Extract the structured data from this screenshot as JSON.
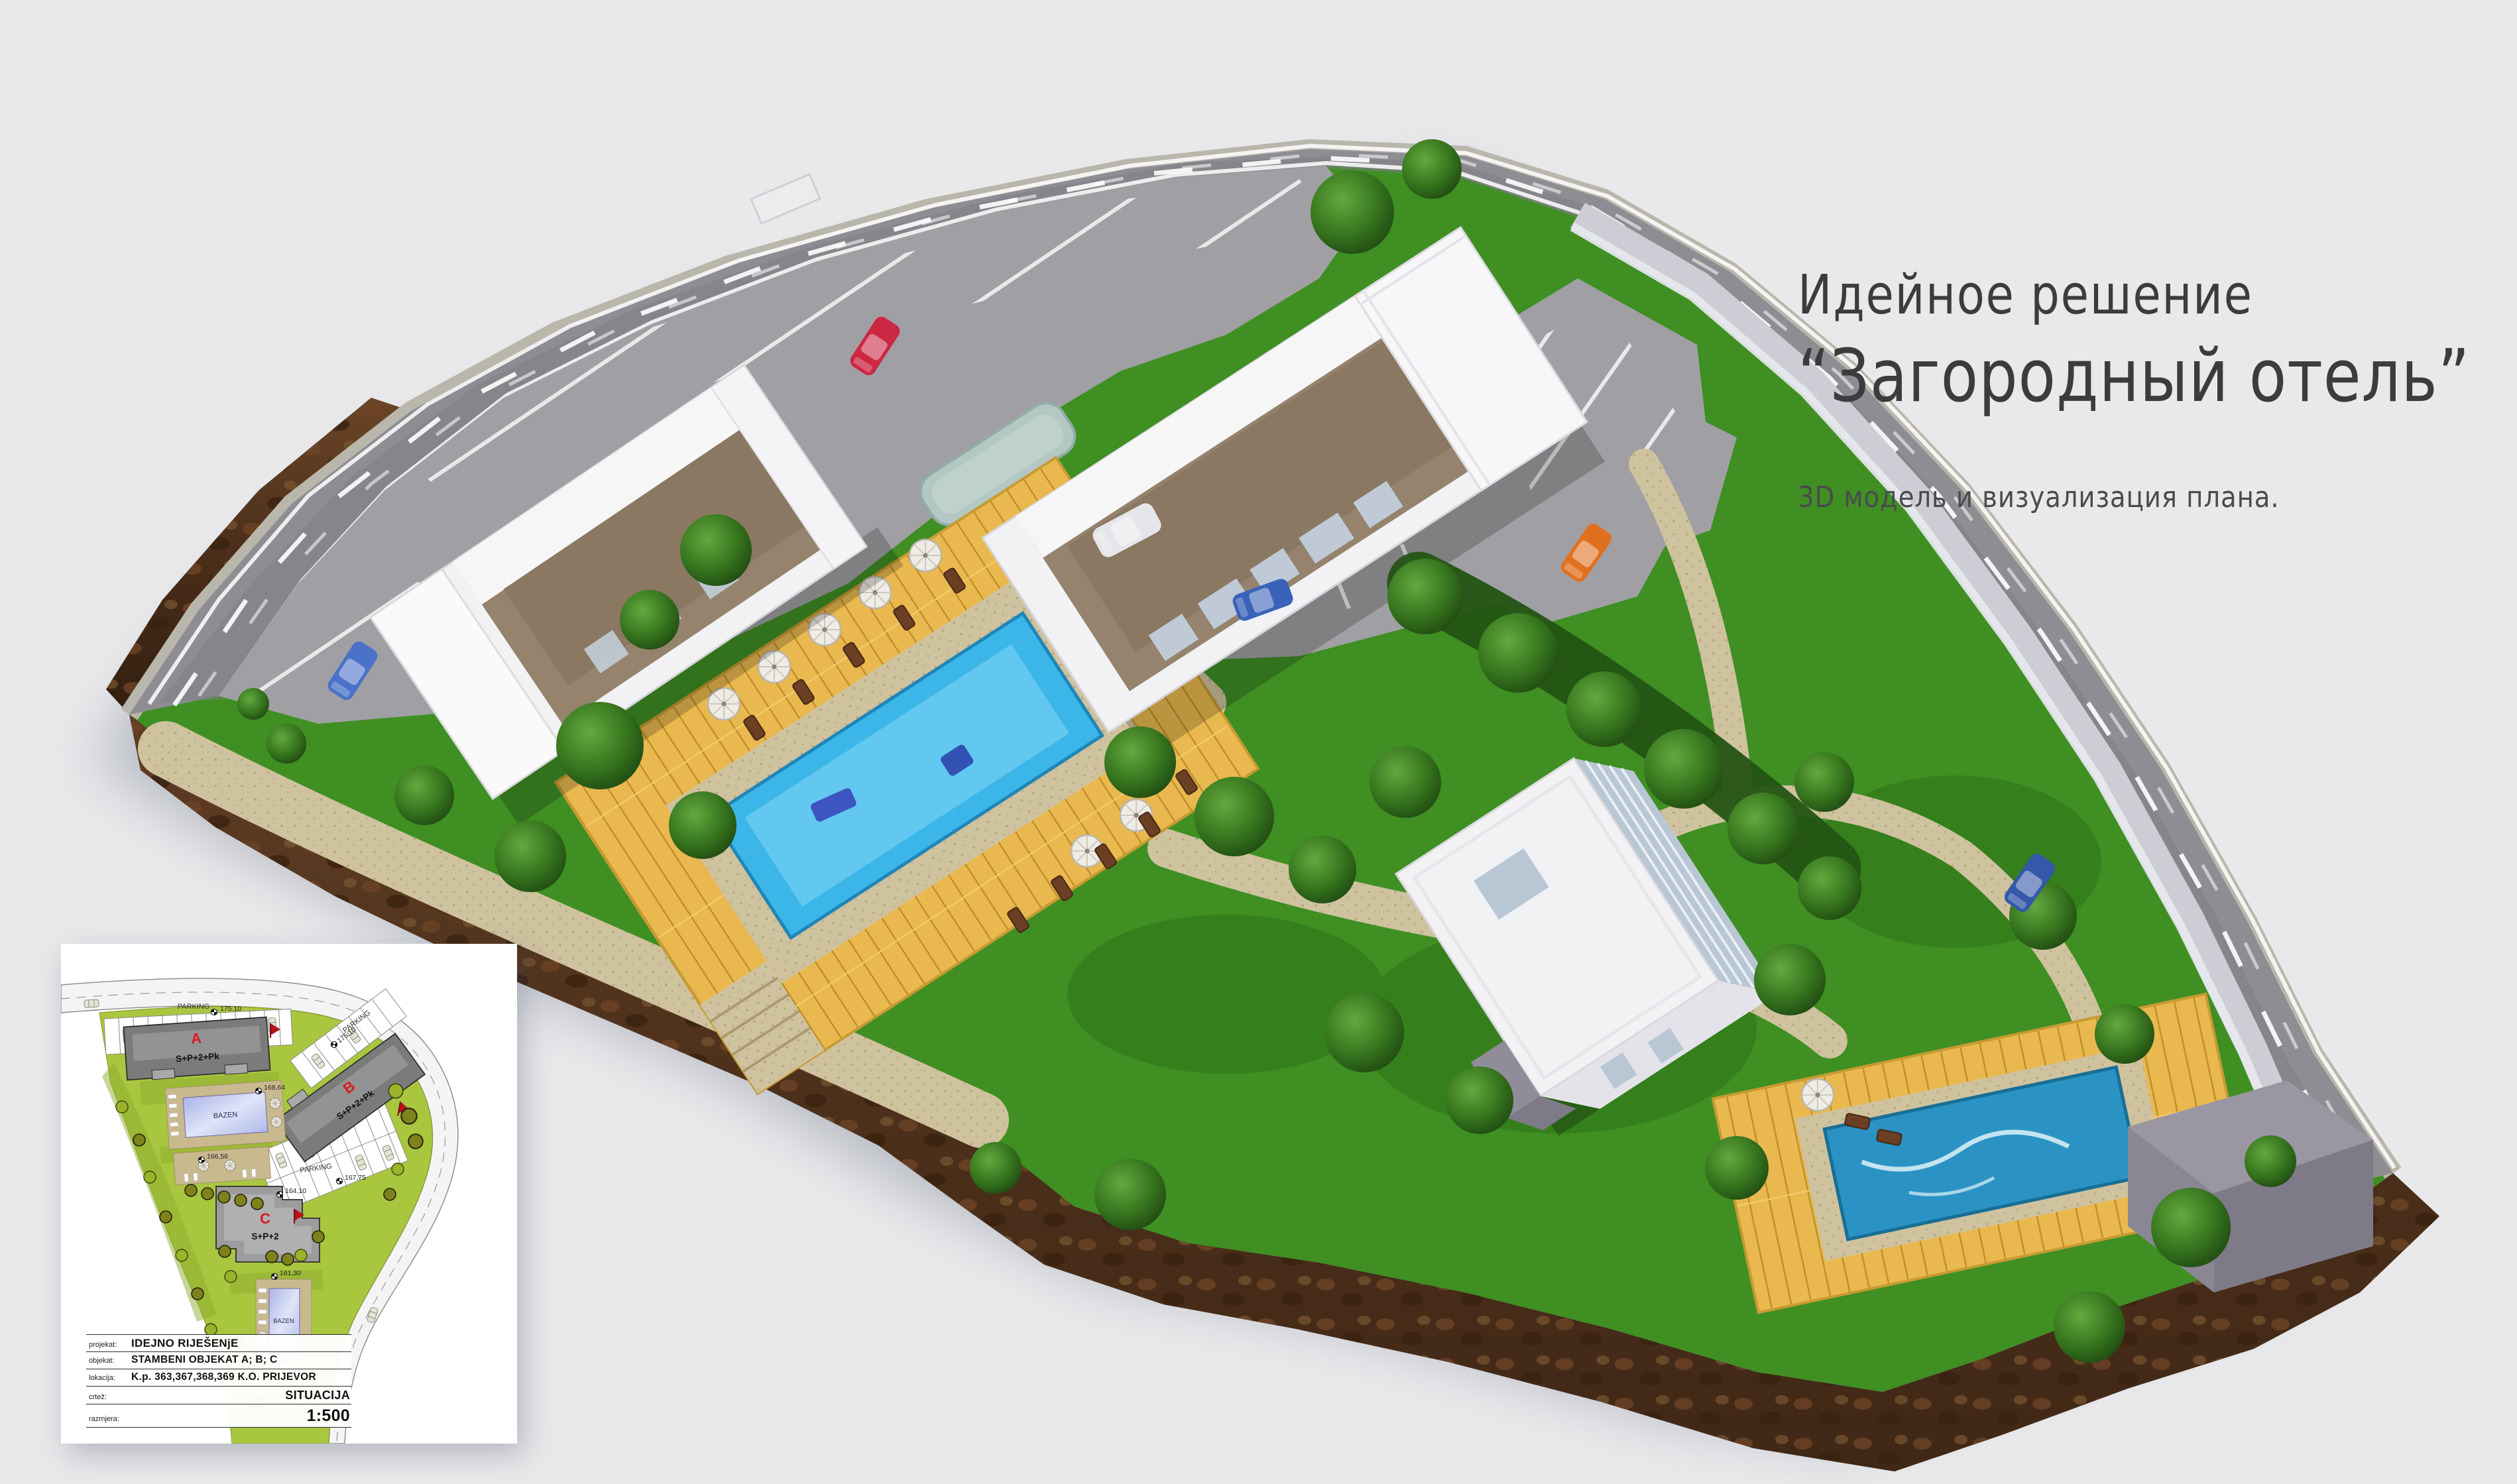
{
  "title": {
    "line1": "Идейное решение",
    "line2": "“Загородный отель”",
    "subtitle": "3D модель и визуализация плана."
  },
  "inset_plan": {
    "parking_label": "PARKING",
    "pool_label": "BAZEN",
    "buildings": [
      {
        "letter": "A",
        "floors": "S+P+2+Pk"
      },
      {
        "letter": "B",
        "floors": "S+P+2+Pk"
      },
      {
        "letter": "C",
        "floors": "S+P+2"
      }
    ],
    "elevations": {
      "near_a": "175.10",
      "near_b": "175.10",
      "pool_upper": "168,64",
      "terrace": "166,56",
      "parking_mid": "167,75",
      "near_c": "164,10",
      "pool_lower": "161,30"
    },
    "title_block": {
      "rows": [
        {
          "label": "projekat:",
          "value": "IDEJNO RIJEŠENjE"
        },
        {
          "label": "objekat:",
          "value": "STAMBENI OBJEKAT  A; B; C"
        },
        {
          "label": "lokacija:",
          "value": "K.p. 363,367,368,369 K.O. PRIJEVOR"
        },
        {
          "label": "crtež:",
          "value": "SITUACIJA"
        },
        {
          "label": "razmjera:",
          "value": "1:500"
        }
      ]
    }
  },
  "colors": {
    "background": "#e9e9eb",
    "grass": "#3f8f23",
    "road": "#8d8d93",
    "parking": "#a0a0a4",
    "soil": "#50331e",
    "deck_wood": "#e9b94f",
    "pool_main": "#3cb6e8",
    "pool_second": "#2a93c4",
    "paving": "#cfc29e",
    "building_white": "#f2f2f4",
    "building_brown": "#95836d",
    "glass": "#b9c6d4",
    "retaining_wall": "#cdcdd6",
    "box_gray": "#9a96a2",
    "tree_green": "#2f6b1d",
    "plan_green": "#a9c63f",
    "plan_building_gray": "#7b7b7b",
    "plan_pool_blue": "#b8c2ec",
    "plan_deck_tan": "#c9b98f",
    "accent_red": "#d81a20",
    "title_text": "#3c3c3e"
  }
}
